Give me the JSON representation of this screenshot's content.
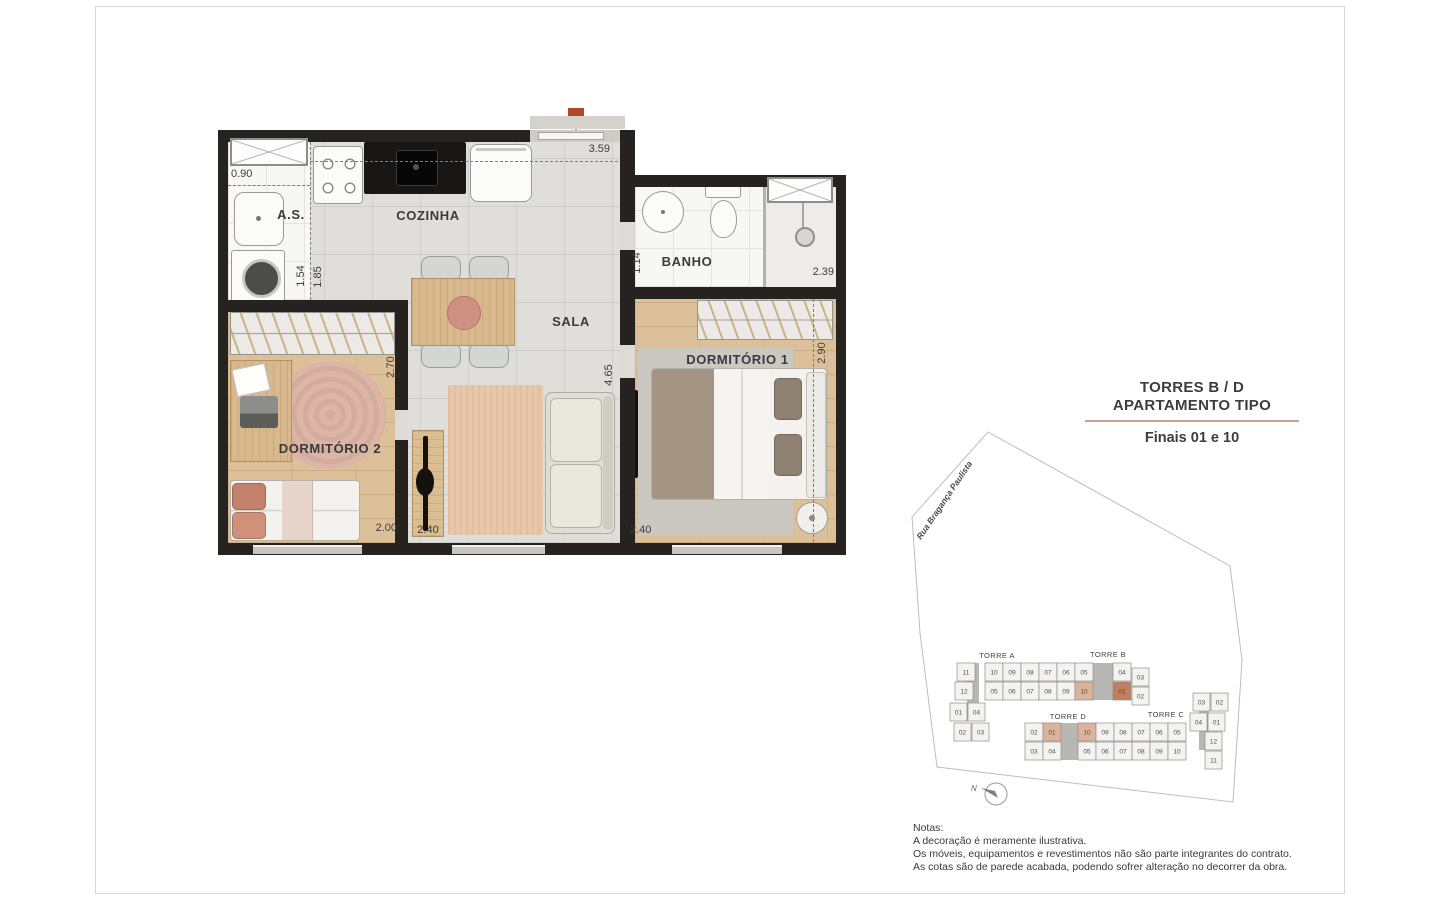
{
  "colors": {
    "entry_arrow": "#b04726",
    "title_underline": "#c9a18a",
    "wall": "#26221f"
  },
  "header": {
    "title_line1": "TORRES B / D",
    "title_line2": "APARTAMENTO TIPO",
    "subtitle": "Finais 01 e 10"
  },
  "floorplan": {
    "rooms": {
      "service": "A.S.",
      "kitchen": "COZINHA",
      "living": "SALA",
      "bath": "BANHO",
      "bedroom1": "DORMITÓRIO 1",
      "bedroom2": "DORMITÓRIO 2"
    },
    "dimensions": {
      "service_width": "0.90",
      "kitchen_width": "3.59",
      "service_depth": "1.54",
      "kitchen_depth": "1.85",
      "bath_depth": "1.14",
      "bath_width": "2.39",
      "bedroom2_depth": "2.70",
      "bedroom1_depth": "2.90",
      "living_depth": "4.65",
      "bedroom2_width": "2.00",
      "hall_width": "2.40",
      "bedroom1_width": "2.40"
    }
  },
  "siteplan": {
    "street": "Rua Bragança Paulista",
    "north": "N",
    "colors": {
      "unit": "#f4f3f1",
      "hl_light": "#dcb29b",
      "hl_dark": "#c07f5f"
    },
    "towers": [
      {
        "label": "TORRE A",
        "x": 92,
        "y": 228
      },
      {
        "label": "TORRE B",
        "x": 203,
        "y": 227
      },
      {
        "label": "TORRE D",
        "x": 163,
        "y": 289
      },
      {
        "label": "TORRE C",
        "x": 261,
        "y": 287
      }
    ],
    "cells": [
      {
        "tower": "A",
        "label": "11",
        "x": 52,
        "y": 233
      },
      {
        "tower": "A",
        "label": "12",
        "x": 50,
        "y": 252
      },
      {
        "tower": "A",
        "label": "01",
        "x": 45,
        "y": 273,
        "w": 17
      },
      {
        "tower": "A",
        "label": "04",
        "x": 63,
        "y": 273,
        "w": 17
      },
      {
        "tower": "A",
        "label": "02",
        "x": 49,
        "y": 293,
        "w": 17
      },
      {
        "tower": "A",
        "label": "03",
        "x": 67,
        "y": 293,
        "w": 17
      },
      {
        "tower": "A",
        "label": "10",
        "x": 80,
        "y": 233
      },
      {
        "tower": "A",
        "label": "09",
        "x": 98,
        "y": 233
      },
      {
        "tower": "A",
        "label": "08",
        "x": 116,
        "y": 233
      },
      {
        "tower": "A",
        "label": "07",
        "x": 134,
        "y": 233
      },
      {
        "tower": "A",
        "label": "05",
        "x": 80,
        "y": 252
      },
      {
        "tower": "A",
        "label": "06",
        "x": 98,
        "y": 252
      },
      {
        "tower": "A",
        "label": "07",
        "x": 116,
        "y": 252
      },
      {
        "tower": "A",
        "label": "08",
        "x": 134,
        "y": 252
      },
      {
        "tower": "B",
        "label": "06",
        "x": 152,
        "y": 233
      },
      {
        "tower": "B",
        "label": "05",
        "x": 170,
        "y": 233
      },
      {
        "tower": "B",
        "label": "04",
        "x": 208,
        "y": 233
      },
      {
        "tower": "B",
        "label": "09",
        "x": 152,
        "y": 252
      },
      {
        "tower": "B",
        "label": "10",
        "x": 170,
        "y": 252,
        "hl": "hl_light"
      },
      {
        "tower": "B",
        "label": "01",
        "x": 208,
        "y": 252,
        "hl": "hl_dark"
      },
      {
        "tower": "B",
        "label": "03",
        "x": 227,
        "y": 238,
        "w": 17
      },
      {
        "tower": "B",
        "label": "02",
        "x": 227,
        "y": 257,
        "w": 17
      },
      {
        "tower": "D",
        "label": "02",
        "x": 120,
        "y": 293
      },
      {
        "tower": "D",
        "label": "01",
        "x": 138,
        "y": 293,
        "hl": "hl_light"
      },
      {
        "tower": "D",
        "label": "10",
        "x": 173,
        "y": 293,
        "hl": "hl_light"
      },
      {
        "tower": "D",
        "label": "09",
        "x": 191,
        "y": 293
      },
      {
        "tower": "D",
        "label": "03",
        "x": 120,
        "y": 312
      },
      {
        "tower": "D",
        "label": "04",
        "x": 138,
        "y": 312
      },
      {
        "tower": "D",
        "label": "05",
        "x": 173,
        "y": 312
      },
      {
        "tower": "D",
        "label": "06",
        "x": 191,
        "y": 312
      },
      {
        "tower": "C",
        "label": "08",
        "x": 209,
        "y": 293
      },
      {
        "tower": "C",
        "label": "07",
        "x": 227,
        "y": 293
      },
      {
        "tower": "C",
        "label": "06",
        "x": 245,
        "y": 293
      },
      {
        "tower": "C",
        "label": "05",
        "x": 263,
        "y": 293
      },
      {
        "tower": "C",
        "label": "07",
        "x": 209,
        "y": 312
      },
      {
        "tower": "C",
        "label": "08",
        "x": 227,
        "y": 312
      },
      {
        "tower": "C",
        "label": "09",
        "x": 245,
        "y": 312
      },
      {
        "tower": "C",
        "label": "10",
        "x": 263,
        "y": 312
      },
      {
        "tower": "C",
        "label": "03",
        "x": 288,
        "y": 263,
        "w": 17
      },
      {
        "tower": "C",
        "label": "02",
        "x": 306,
        "y": 263,
        "w": 17
      },
      {
        "tower": "C",
        "label": "04",
        "x": 285,
        "y": 283,
        "w": 17
      },
      {
        "tower": "C",
        "label": "01",
        "x": 303,
        "y": 283,
        "w": 17
      },
      {
        "tower": "C",
        "label": "12",
        "x": 300,
        "y": 302,
        "w": 17
      },
      {
        "tower": "C",
        "label": "11",
        "x": 300,
        "y": 321,
        "w": 17
      }
    ]
  },
  "notes": {
    "title": "Notas:",
    "lines": [
      "A decoração é meramente ilustrativa.",
      "Os móveis, equipamentos e revestimentos não são parte integrantes do contrato.",
      "As cotas são de parede acabada, podendo sofrer alteração no decorrer da obra."
    ]
  }
}
